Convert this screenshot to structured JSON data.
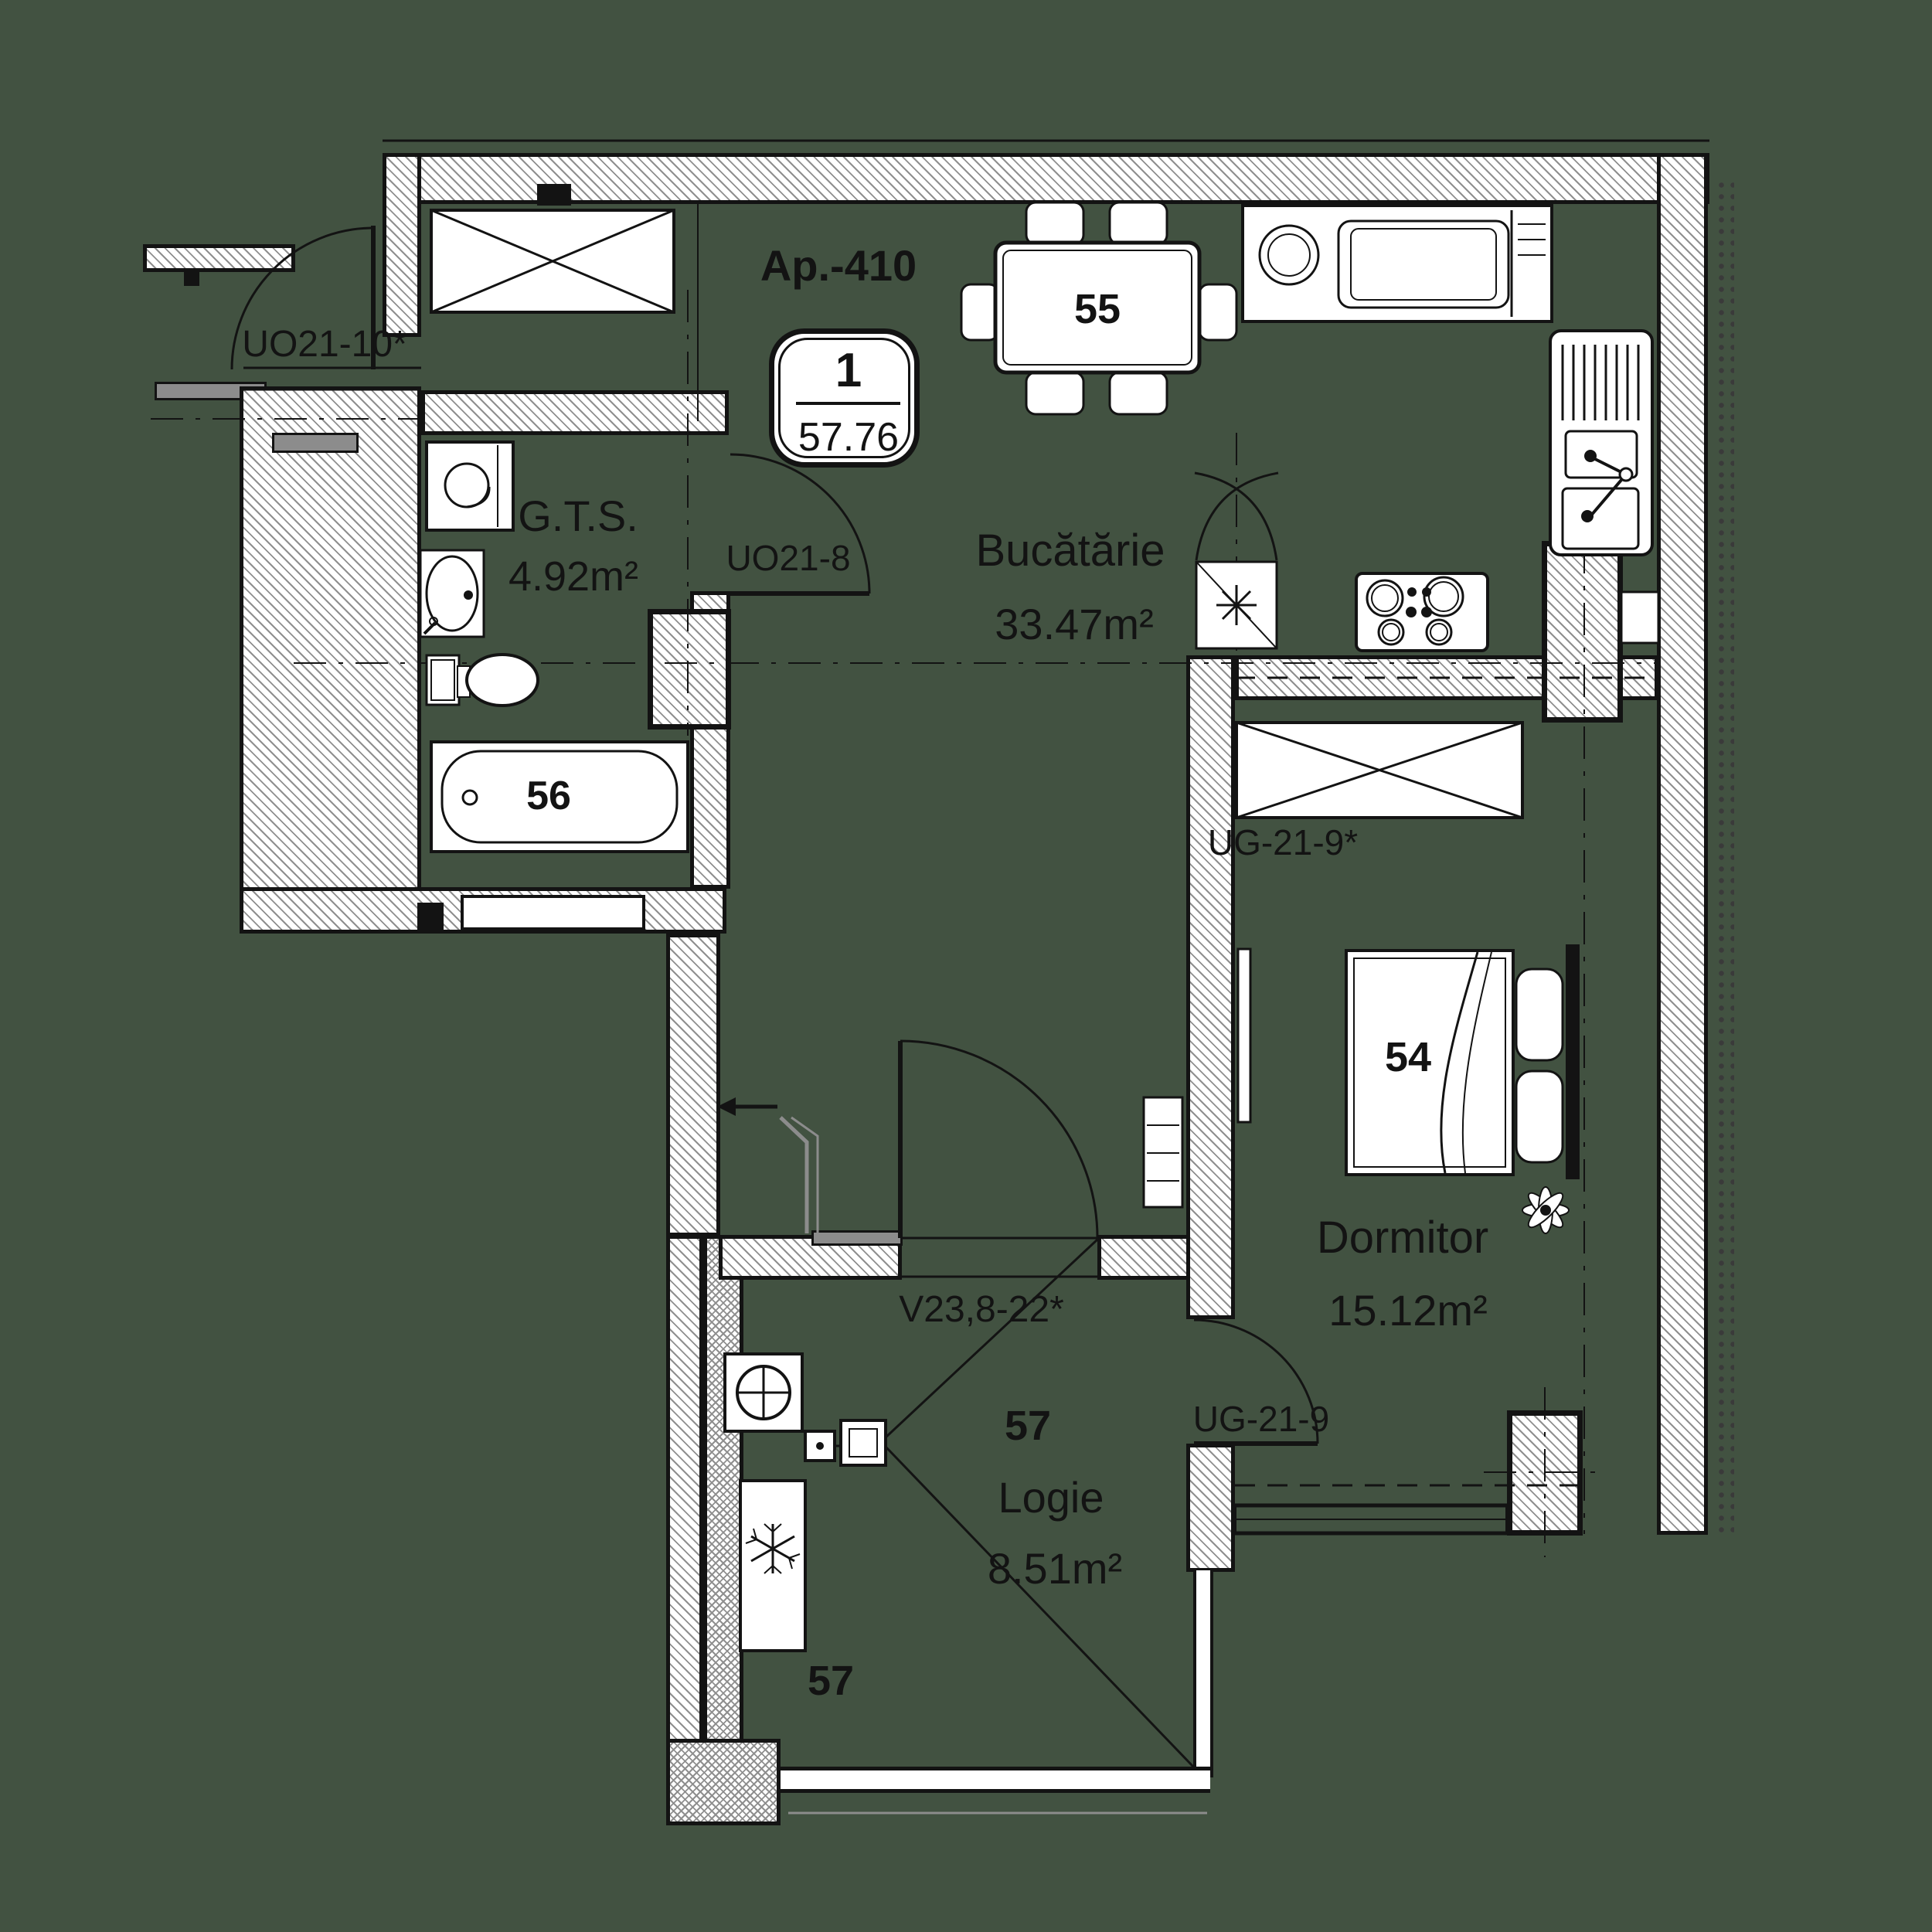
{
  "header": {
    "apartment": "Ap.-410"
  },
  "badge": {
    "rooms_count": "1",
    "total_area": "57.76"
  },
  "rooms": {
    "gts": {
      "name": "G.T.S.",
      "area": "4.92m²"
    },
    "kitchen": {
      "name": "Bucătărie",
      "area": "33.47m²"
    },
    "bedroom": {
      "name": "Dormitor",
      "area": "15.12m²"
    },
    "loggia": {
      "name": "Logie",
      "area": "8.51m²"
    }
  },
  "doors": {
    "entry": "UO21-10*",
    "bathroom": "UO21-8",
    "bedroom": "UG-21-9*",
    "bedroom_loggia": "UG-21-9",
    "loggia_window": "V23,8-22*"
  },
  "numbers": {
    "dining_table": "55",
    "bathtub": "56",
    "bed": "54",
    "loggia_upper": "57",
    "loggia_lower": "57"
  },
  "colors": {
    "canvas": "#425241",
    "line": "#131313",
    "hatch": "#8f8f8f",
    "fixture-gray": "#8c8c8c",
    "insulation": "#3a3a3a"
  }
}
